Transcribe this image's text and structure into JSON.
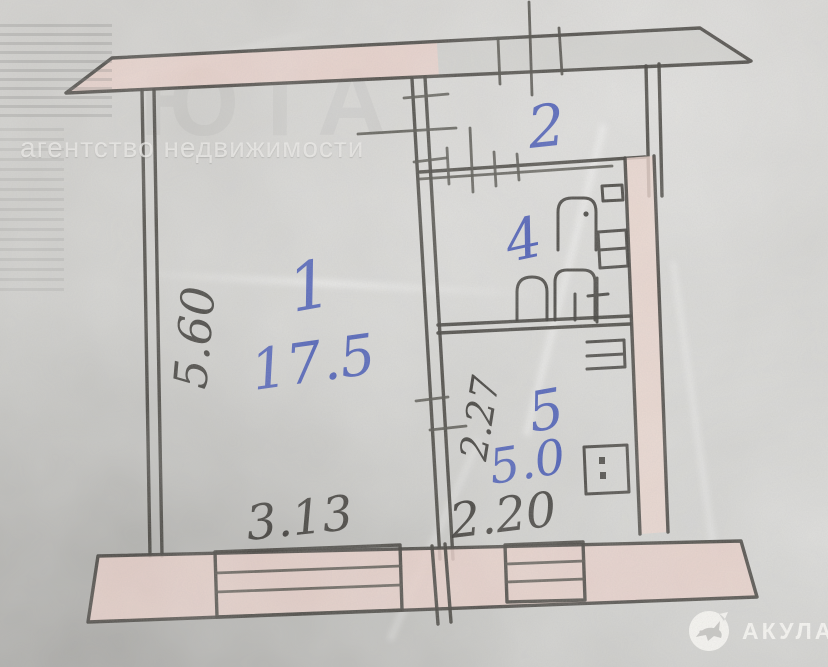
{
  "watermarks": {
    "agency_line": "агентство недвижимости",
    "agency_name_faint": "ЮТА",
    "brand": "АКУЛА"
  },
  "plan": {
    "room_labels": [
      {
        "number": "1",
        "area": "17.5"
      },
      {
        "number": "2",
        "area": ""
      },
      {
        "number": "4",
        "area": ""
      },
      {
        "number": "5",
        "area": "5.0"
      }
    ],
    "dimensions": {
      "left_vertical": "5.60",
      "center_vertical": "2.27",
      "bottom_left": "3.13",
      "bottom_right": "2.20"
    },
    "fixtures": [
      "bathtub",
      "sink",
      "stove",
      "radiator",
      "toilet"
    ],
    "colors": {
      "ink": "#3f3d38",
      "pen_blue": "#3c50b2",
      "wall_fill": "#e9cfc8",
      "paper": "#cdccc9"
    }
  }
}
